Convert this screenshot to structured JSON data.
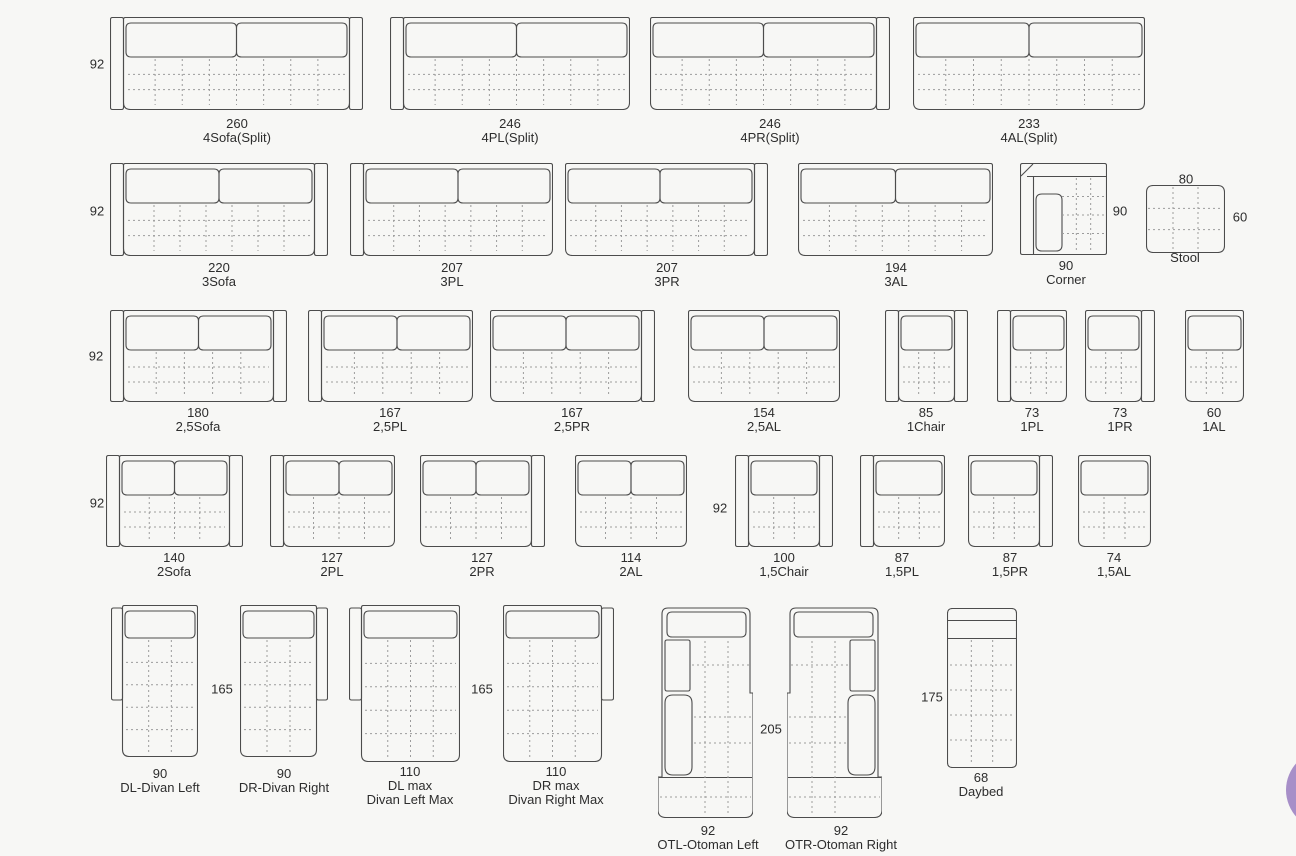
{
  "colors": {
    "line": "#4c4c4c",
    "dash": "#9c9c9c",
    "text": "#2d2d2d",
    "background": "#f7f7f5",
    "fab": "#a78fc8"
  },
  "modules": [
    {
      "kind": "std",
      "name": "4Sofa(Split)",
      "labels": [
        "260",
        "4Sofa(Split)"
      ],
      "x": 110,
      "y": 17,
      "w": 253,
      "h": 93,
      "arms": "both",
      "cushions": 2,
      "cx": 237,
      "ly": 117
    },
    {
      "kind": "std",
      "name": "4PL(Split)",
      "labels": [
        "246",
        "4PL(Split)"
      ],
      "x": 390,
      "y": 17,
      "w": 240,
      "h": 93,
      "arms": "left",
      "cushions": 2,
      "cx": 510,
      "ly": 117
    },
    {
      "kind": "std",
      "name": "4PR(Split)",
      "labels": [
        "246",
        "4PR(Split)"
      ],
      "x": 650,
      "y": 17,
      "w": 240,
      "h": 93,
      "arms": "right",
      "cushions": 2,
      "cx": 770,
      "ly": 117
    },
    {
      "kind": "std",
      "name": "4AL(Split)",
      "labels": [
        "233",
        "4AL(Split)"
      ],
      "x": 913,
      "y": 17,
      "w": 232,
      "h": 93,
      "arms": "none",
      "cushions": 2,
      "cx": 1029,
      "ly": 117
    },
    {
      "kind": "std",
      "name": "3Sofa",
      "labels": [
        "220",
        "3Sofa"
      ],
      "x": 110,
      "y": 163,
      "w": 218,
      "h": 93,
      "arms": "both",
      "cushions": 2,
      "cx": 219,
      "ly": 261
    },
    {
      "kind": "std",
      "name": "3PL",
      "labels": [
        "207",
        "3PL"
      ],
      "x": 350,
      "y": 163,
      "w": 203,
      "h": 93,
      "arms": "left",
      "cushions": 2,
      "cx": 452,
      "ly": 261
    },
    {
      "kind": "std",
      "name": "3PR",
      "labels": [
        "207",
        "3PR"
      ],
      "x": 565,
      "y": 163,
      "w": 203,
      "h": 93,
      "arms": "right",
      "cushions": 2,
      "cx": 667,
      "ly": 261
    },
    {
      "kind": "std",
      "name": "3AL",
      "labels": [
        "194",
        "3AL"
      ],
      "x": 798,
      "y": 163,
      "w": 195,
      "h": 93,
      "arms": "none",
      "cushions": 2,
      "cx": 896,
      "ly": 261
    },
    {
      "kind": "corner",
      "name": "Corner",
      "labels": [
        "90",
        "Corner"
      ],
      "x": 1020,
      "y": 163,
      "w": 87,
      "h": 92,
      "cx": 1066,
      "ly": 259
    },
    {
      "kind": "stool",
      "name": "Stool",
      "labels": [
        "Stool"
      ],
      "x": 1146,
      "y": 185,
      "w": 79,
      "h": 68,
      "cx": 1185,
      "ly": 251
    },
    {
      "kind": "std",
      "name": "2,5Sofa",
      "labels": [
        "180",
        "2,5Sofa"
      ],
      "x": 110,
      "y": 310,
      "w": 177,
      "h": 92,
      "arms": "both",
      "cushions": 2,
      "cx": 198,
      "ly": 406
    },
    {
      "kind": "std",
      "name": "2,5PL",
      "labels": [
        "167",
        "2,5PL"
      ],
      "x": 308,
      "y": 310,
      "w": 165,
      "h": 92,
      "arms": "left",
      "cushions": 2,
      "cx": 390,
      "ly": 406
    },
    {
      "kind": "std",
      "name": "2,5PR",
      "labels": [
        "167",
        "2,5PR"
      ],
      "x": 490,
      "y": 310,
      "w": 165,
      "h": 92,
      "arms": "right",
      "cushions": 2,
      "cx": 572,
      "ly": 406
    },
    {
      "kind": "std",
      "name": "2,5AL",
      "labels": [
        "154",
        "2,5AL"
      ],
      "x": 688,
      "y": 310,
      "w": 152,
      "h": 92,
      "arms": "none",
      "cushions": 2,
      "cx": 764,
      "ly": 406
    },
    {
      "kind": "std",
      "name": "1Chair",
      "labels": [
        "85",
        "1Chair"
      ],
      "x": 885,
      "y": 310,
      "w": 83,
      "h": 92,
      "arms": "both",
      "cushions": 1,
      "cx": 926,
      "ly": 406
    },
    {
      "kind": "std",
      "name": "1PL",
      "labels": [
        "73",
        "1PL"
      ],
      "x": 997,
      "y": 310,
      "w": 70,
      "h": 92,
      "arms": "left",
      "cushions": 1,
      "cx": 1032,
      "ly": 406
    },
    {
      "kind": "std",
      "name": "1PR",
      "labels": [
        "73",
        "1PR"
      ],
      "x": 1085,
      "y": 310,
      "w": 70,
      "h": 92,
      "arms": "right",
      "cushions": 1,
      "cx": 1120,
      "ly": 406
    },
    {
      "kind": "std",
      "name": "1AL",
      "labels": [
        "60",
        "1AL"
      ],
      "x": 1185,
      "y": 310,
      "w": 59,
      "h": 92,
      "arms": "none",
      "cushions": 1,
      "cx": 1214,
      "ly": 406
    },
    {
      "kind": "std",
      "name": "2Sofa",
      "labels": [
        "140",
        "2Sofa"
      ],
      "x": 106,
      "y": 455,
      "w": 137,
      "h": 92,
      "arms": "both",
      "cushions": 2,
      "cx": 174,
      "ly": 551
    },
    {
      "kind": "std",
      "name": "2PL",
      "labels": [
        "127",
        "2PL"
      ],
      "x": 270,
      "y": 455,
      "w": 125,
      "h": 92,
      "arms": "left",
      "cushions": 2,
      "cx": 332,
      "ly": 551
    },
    {
      "kind": "std",
      "name": "2PR",
      "labels": [
        "127",
        "2PR"
      ],
      "x": 420,
      "y": 455,
      "w": 125,
      "h": 92,
      "arms": "right",
      "cushions": 2,
      "cx": 482,
      "ly": 551
    },
    {
      "kind": "std",
      "name": "2AL",
      "labels": [
        "114",
        "2AL"
      ],
      "x": 575,
      "y": 455,
      "w": 112,
      "h": 92,
      "arms": "none",
      "cushions": 2,
      "cx": 631,
      "ly": 551
    },
    {
      "kind": "std",
      "name": "1,5Chair",
      "labels": [
        "100",
        "1,5Chair"
      ],
      "x": 735,
      "y": 455,
      "w": 98,
      "h": 92,
      "arms": "both",
      "cushions": 1,
      "cx": 784,
      "ly": 551
    },
    {
      "kind": "std",
      "name": "1,5PL",
      "labels": [
        "87",
        "1,5PL"
      ],
      "x": 860,
      "y": 455,
      "w": 85,
      "h": 92,
      "arms": "left",
      "cushions": 1,
      "cx": 902,
      "ly": 551
    },
    {
      "kind": "std",
      "name": "1,5PR",
      "labels": [
        "87",
        "1,5PR"
      ],
      "x": 968,
      "y": 455,
      "w": 85,
      "h": 92,
      "arms": "right",
      "cushions": 1,
      "cx": 1010,
      "ly": 551
    },
    {
      "kind": "std",
      "name": "1,5AL",
      "labels": [
        "74",
        "1,5AL"
      ],
      "x": 1078,
      "y": 455,
      "w": 73,
      "h": 92,
      "arms": "none",
      "cushions": 1,
      "cx": 1114,
      "ly": 551
    },
    {
      "kind": "divan",
      "name": "DL-Divan Left",
      "labels": [
        "90",
        "DL-Divan Left"
      ],
      "x": 111,
      "y": 605,
      "w": 87,
      "h": 152,
      "side": "left",
      "cx": 160,
      "ly": 767
    },
    {
      "kind": "divan",
      "name": "DR-Divan Right",
      "labels": [
        "90",
        "DR-Divan Right"
      ],
      "x": 240,
      "y": 605,
      "w": 88,
      "h": 152,
      "side": "right",
      "cx": 284,
      "ly": 767
    },
    {
      "kind": "divanmax",
      "name": "DL max Divan Left Max",
      "labels": [
        "110",
        "DL max",
        "Divan Left Max"
      ],
      "x": 349,
      "y": 605,
      "w": 111,
      "h": 157,
      "side": "left",
      "cx": 410,
      "ly": 765
    },
    {
      "kind": "divanmax",
      "name": "DR max Divan Right Max",
      "labels": [
        "110",
        "DR max",
        "Divan Right Max"
      ],
      "x": 503,
      "y": 605,
      "w": 111,
      "h": 157,
      "side": "right",
      "cx": 556,
      "ly": 765
    },
    {
      "kind": "ottoman",
      "name": "OTL-Otoman Left",
      "labels": [
        "92",
        "OTL-Otoman Left"
      ],
      "x": 658,
      "y": 605,
      "w": 95,
      "h": 213,
      "side": "left",
      "cx": 708,
      "ly": 824
    },
    {
      "kind": "ottoman",
      "name": "OTR-Otoman Right",
      "labels": [
        "92",
        "OTR-Otoman Right"
      ],
      "x": 787,
      "y": 605,
      "w": 95,
      "h": 213,
      "side": "right",
      "cx": 841,
      "ly": 824
    },
    {
      "kind": "daybed",
      "name": "Daybed",
      "labels": [
        "68",
        "Daybed"
      ],
      "x": 947,
      "y": 608,
      "w": 70,
      "h": 160,
      "cx": 981,
      "ly": 771
    }
  ],
  "annotations": [
    {
      "text": "92",
      "x": 97,
      "y": 64
    },
    {
      "text": "92",
      "x": 97,
      "y": 211
    },
    {
      "text": "92",
      "x": 96,
      "y": 356
    },
    {
      "text": "92",
      "x": 97,
      "y": 503
    },
    {
      "text": "92",
      "x": 720,
      "y": 508
    },
    {
      "text": "90",
      "x": 1120,
      "y": 211
    },
    {
      "text": "80",
      "x": 1186,
      "y": 179
    },
    {
      "text": "60",
      "x": 1240,
      "y": 217
    },
    {
      "text": "165",
      "x": 222,
      "y": 689
    },
    {
      "text": "165",
      "x": 482,
      "y": 689
    },
    {
      "text": "205",
      "x": 771,
      "y": 729
    },
    {
      "text": "175",
      "x": 932,
      "y": 697
    }
  ]
}
